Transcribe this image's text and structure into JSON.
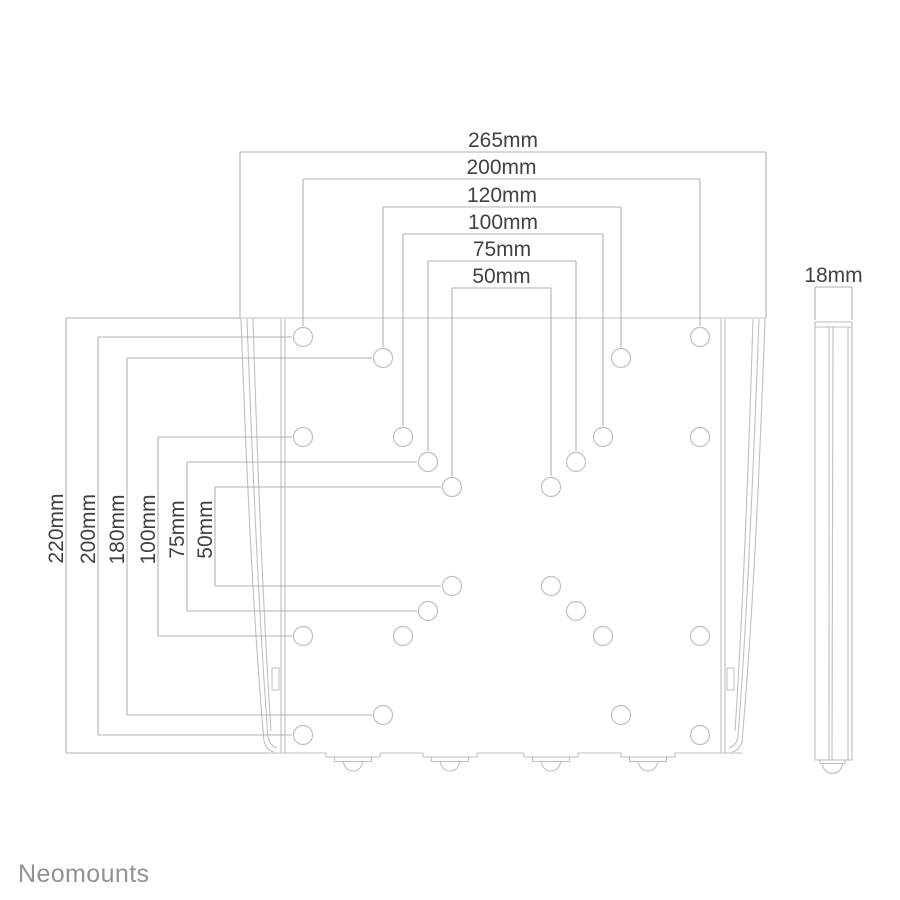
{
  "page": {
    "background": "#ffffff",
    "width": 900,
    "height": 900
  },
  "branding": {
    "logo_text": "Neomounts"
  },
  "colors": {
    "drawing_line": "#bcc0c1",
    "dimension_line": "#aeb2b3",
    "dimension_text": "#3d4245",
    "logo_text": "#8f9193",
    "hole_fill": "#ffffff"
  },
  "front_view": {
    "plate": {
      "x": 240,
      "y": 318,
      "width": 526,
      "height": 435
    },
    "hole_radius": 9.5,
    "holes": [
      {
        "x": 303,
        "y": 337
      },
      {
        "x": 700,
        "y": 337
      },
      {
        "x": 383,
        "y": 358
      },
      {
        "x": 621,
        "y": 358
      },
      {
        "x": 303,
        "y": 437
      },
      {
        "x": 403,
        "y": 437
      },
      {
        "x": 603,
        "y": 437
      },
      {
        "x": 700,
        "y": 437
      },
      {
        "x": 428,
        "y": 462
      },
      {
        "x": 576,
        "y": 462
      },
      {
        "x": 452,
        "y": 487
      },
      {
        "x": 551,
        "y": 487
      },
      {
        "x": 452,
        "y": 586
      },
      {
        "x": 551,
        "y": 586
      },
      {
        "x": 428,
        "y": 611
      },
      {
        "x": 576,
        "y": 611
      },
      {
        "x": 303,
        "y": 636
      },
      {
        "x": 403,
        "y": 636
      },
      {
        "x": 603,
        "y": 636
      },
      {
        "x": 700,
        "y": 636
      },
      {
        "x": 383,
        "y": 715
      },
      {
        "x": 621,
        "y": 715
      },
      {
        "x": 303,
        "y": 735
      },
      {
        "x": 700,
        "y": 735
      }
    ],
    "clip_centers": [
      353,
      450,
      551,
      648
    ]
  },
  "top_dimensions": [
    {
      "label": "265mm",
      "y": 152,
      "x1": 240,
      "x2": 766,
      "drop_to": 318
    },
    {
      "label": "200mm",
      "y": 179,
      "x1": 303,
      "x2": 700,
      "drop_to": 326
    },
    {
      "label": "120mm",
      "y": 207,
      "x1": 383,
      "x2": 621,
      "drop_to": 347
    },
    {
      "label": "100mm",
      "y": 234,
      "x1": 403,
      "x2": 603,
      "drop_to": 426
    },
    {
      "label": "75mm",
      "y": 261,
      "x1": 428,
      "x2": 576,
      "drop_to": 451
    },
    {
      "label": "50mm",
      "y": 288,
      "x1": 452,
      "x2": 551,
      "drop_to": 476
    }
  ],
  "left_dimensions": [
    {
      "label": "220mm",
      "x": 66,
      "y1": 318,
      "y2": 753,
      "reach_top": 242,
      "reach_bottom": 266
    },
    {
      "label": "200mm",
      "x": 98,
      "y1": 337,
      "y2": 735,
      "reach_top": 292,
      "reach_bottom": 292
    },
    {
      "label": "180mm",
      "x": 127,
      "y1": 358,
      "y2": 715,
      "reach_top": 372,
      "reach_bottom": 372
    },
    {
      "label": "100mm",
      "x": 158,
      "y1": 437,
      "y2": 636,
      "reach_top": 292,
      "reach_bottom": 292
    },
    {
      "label": "75mm",
      "x": 187,
      "y1": 462,
      "y2": 611,
      "reach_top": 417,
      "reach_bottom": 417
    },
    {
      "label": "50mm",
      "x": 215,
      "y1": 487,
      "y2": 586,
      "reach_top": 441,
      "reach_bottom": 441
    }
  ],
  "side_view": {
    "dimension_label": "18mm",
    "x": 815,
    "y": 322,
    "width": 37,
    "height": 438,
    "dim_y": 287
  }
}
